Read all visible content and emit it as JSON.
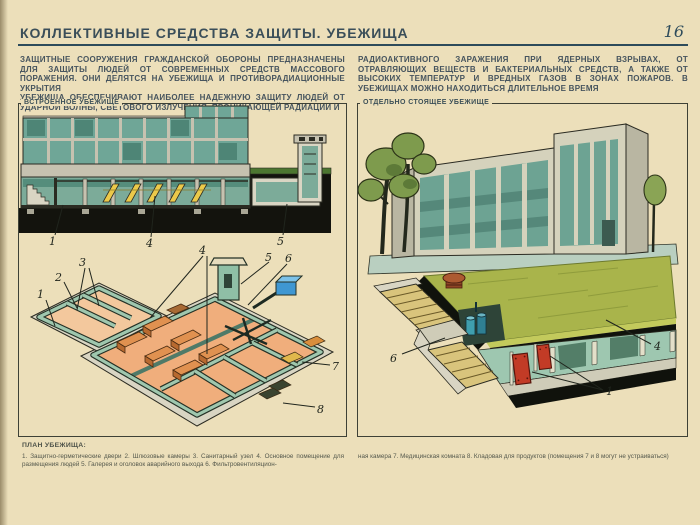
{
  "page": {
    "title": "КОЛЛЕКТИВНЫЕ СРЕДСТВА ЗАЩИТЫ. УБЕЖИЩА",
    "page_number": "16"
  },
  "intro": {
    "left_p1": "ЗАЩИТНЫЕ СООРУЖЕНИЯ ГРАЖДАНСКОЙ ОБОРОНЫ ПРЕДНАЗНАЧЕНЫ ДЛЯ ЗАЩИТЫ ЛЮДЕЙ ОТ СОВРЕМЕННЫХ СРЕДСТВ МАССОВОГО ПОРАЖЕНИЯ. ОНИ ДЕЛЯТСЯ НА УБЕЖИЩА И ПРОТИВОРАДИАЦИОННЫЕ УКРЫТИЯ",
    "left_p2": "УБЕЖИЩА ОБЕСПЕЧИВАЮТ НАИБОЛЕЕ НАДЕЖНУЮ ЗАЩИТУ ЛЮДЕЙ ОТ УДАРНОЙ ВОЛНЫ, СВЕТОВОГО ИЗЛУЧЕНИЯ, ПРОНИКАЮЩЕЙ РАДИАЦИИ И",
    "right_p1": "РАДИОАКТИВНОГО ЗАРАЖЕНИЯ ПРИ ЯДЕРНЫХ ВЗРЫВАХ, ОТ ОТРАВЛЯЮЩИХ ВЕЩЕСТВ И БАКТЕРИАЛЬНЫХ СРЕДСТВ, А ТАКЖЕ ОТ ВЫСОКИХ ТЕМПЕРАТУР И ВРЕДНЫХ ГАЗОВ В ЗОНАХ ПОЖАРОВ. В УБЕЖИЩАХ МОЖНО НАХОДИТЬСЯ ДЛИТЕЛЬНОЕ ВРЕМЯ"
  },
  "figures": {
    "built_in": {
      "label": "ВСТРОЕННОЕ УБЕЖИЩЕ",
      "callouts": {
        "c1": "1",
        "c4": "4",
        "c5": "5"
      }
    },
    "plan": {
      "callouts": {
        "c1": "1",
        "c2": "2",
        "c3": "3",
        "c4": "4",
        "c5": "5",
        "c6": "6",
        "c7": "7",
        "c8": "8"
      }
    },
    "detached": {
      "label": "ОТДЕЛЬНО СТОЯЩЕЕ УБЕЖИЩЕ",
      "callouts": {
        "c6": "6",
        "c1": "1",
        "c4": "4"
      }
    }
  },
  "legend": {
    "heading": "ПЛАН УБЕЖИЩА:",
    "left": "1. Защитно-герметические двери 2. Шлюзовые камеры 3. Санитарный узел 4. Основное помещение для размещения людей 5. Галерея и оголовок аварийного выхода 6. Фильтровентиляцион-",
    "right": "ная камера 7. Медицинская комната 8. Кладовая для продуктов (помещения 7 и 8 могут не устраиваться)"
  },
  "colors": {
    "paper": "#ecdfba",
    "title_ink": "#3a4e59",
    "rule": "#2d4b5b",
    "body_ink": "#46545e",
    "glass_teal": "#6fa697",
    "concrete": "#c6c2b0",
    "soil": "#13130d",
    "floor_peach": "#f0ae7c",
    "bench_orange": "#d98e3c",
    "bunk_yellow": "#ecc94a",
    "grass_roof": "#a9b44b",
    "door_red": "#c23b26",
    "vent_blue": "#3f97d2"
  }
}
